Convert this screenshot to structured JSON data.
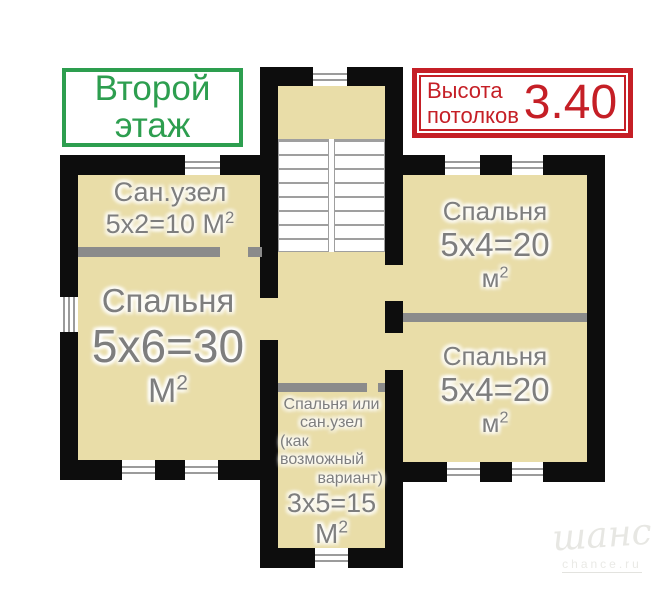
{
  "labels": {
    "floor_box": {
      "line1": "Второй",
      "line2": "этаж"
    },
    "ceiling_box": {
      "word1": "Высота",
      "word2": "потолков",
      "value": "3.40"
    }
  },
  "rooms": {
    "bathroom": {
      "name": "Сан.узел",
      "area": "5х2=10",
      "unit": "М",
      "sup": "2"
    },
    "bedroom_left": {
      "name": "Спальня",
      "area": "5х6=30",
      "unit": "М",
      "sup": "2"
    },
    "bedroom_top_right": {
      "name": "Спальня",
      "area": "5х4=20",
      "unit": "м",
      "sup": "2"
    },
    "bedroom_bottom_right": {
      "name": "Спальня",
      "area": "5х4=20",
      "unit": "м",
      "sup": "2"
    },
    "bedroom_optional": {
      "name_lines": [
        "Спальня или",
        "сан.узел",
        "(как",
        "возможный",
        "вариант)"
      ],
      "area": "3х5=15",
      "unit": "М",
      "sup": "2"
    }
  },
  "watermark": {
    "brand": "шанс",
    "site": "chance.ru"
  },
  "colors": {
    "wall": "#0d0d0d",
    "floor": "#e9dda8",
    "partition": "#8b8b8b",
    "label": "#7e7e7e",
    "green": "#2d9e4f",
    "red": "#c51f26"
  }
}
